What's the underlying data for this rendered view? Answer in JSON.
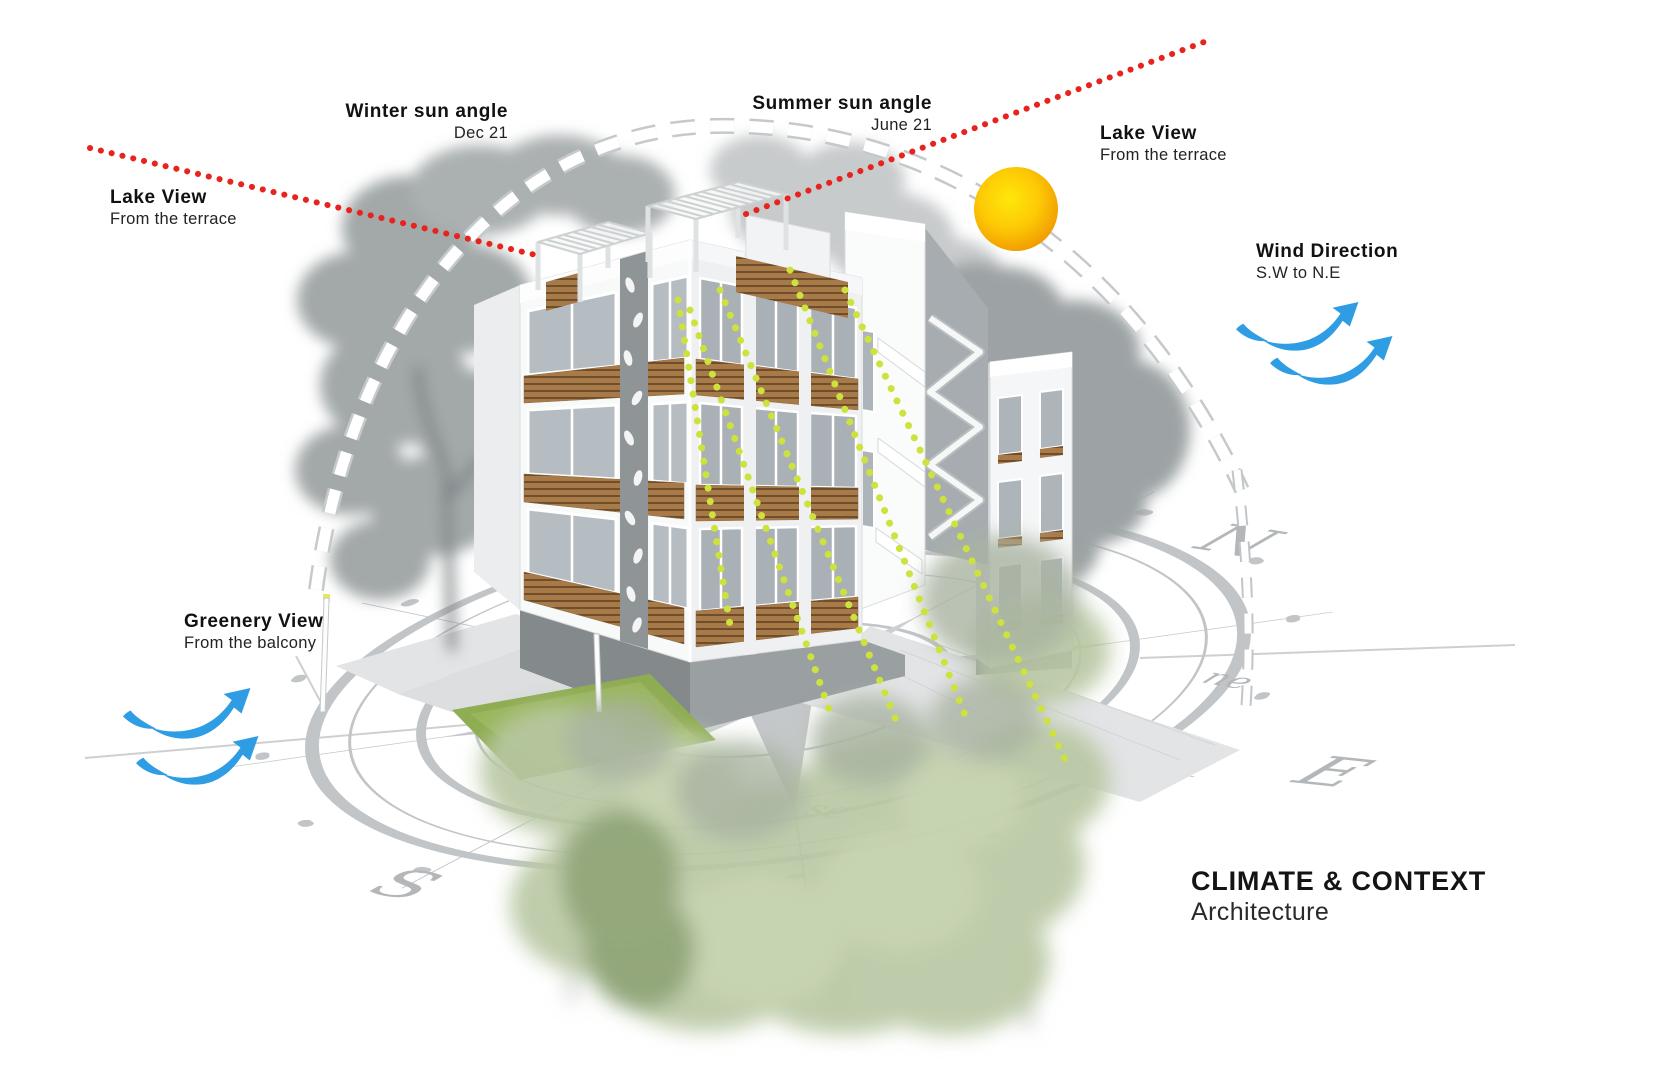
{
  "title": {
    "main": "CLIMATE & CONTEXT",
    "sub": "Architecture"
  },
  "annotations": {
    "winter_sun": {
      "title": "Winter sun angle",
      "subtitle": "Dec 21"
    },
    "summer_sun": {
      "title": "Summer sun angle",
      "subtitle": "June 21"
    },
    "lake_view_left": {
      "title": "Lake View",
      "subtitle": "From the terrace"
    },
    "lake_view_right": {
      "title": "Lake View",
      "subtitle": "From the terrace"
    },
    "wind_direction": {
      "title": "Wind Direction",
      "subtitle": "S.W to N.E"
    },
    "greenery_view": {
      "title": "Greenery View",
      "subtitle": "From the balcony"
    }
  },
  "compass": {
    "n": "N",
    "e": "E",
    "s": "S",
    "ne": "ne",
    "se": "se"
  },
  "colors": {
    "red_sightline": "#e8231d",
    "sun_ray": "#cde23c",
    "wind_arrow": "#2f9de4",
    "sun_center": "#ffe70a",
    "sun_edge": "#f19a02",
    "grass": "#8fad52",
    "wood": "#a87a48"
  }
}
